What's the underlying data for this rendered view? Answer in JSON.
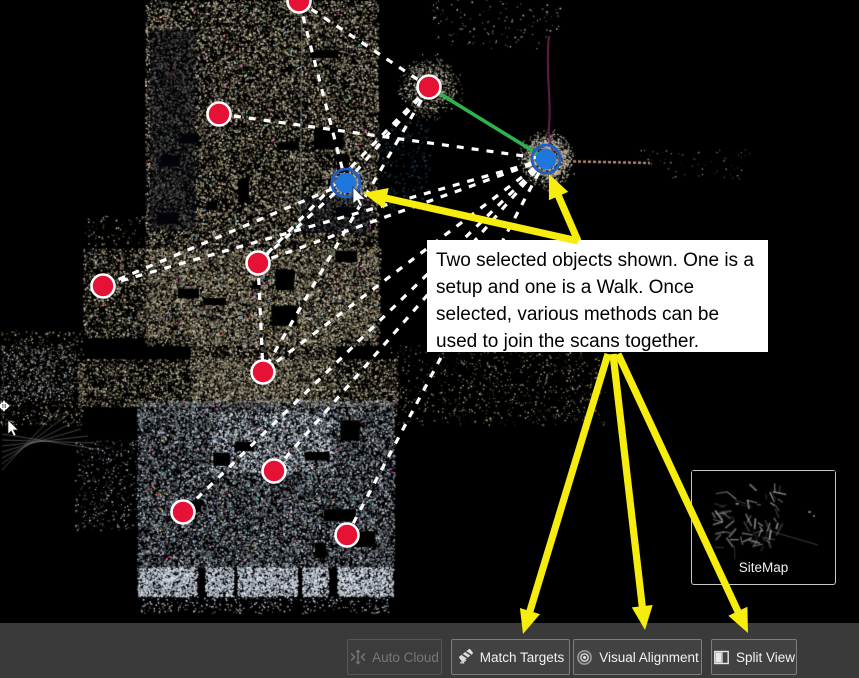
{
  "callout": {
    "lines": [
      "Two selected objects shown. One is a",
      "setup and one is a Walk. Once",
      "selected, various methods can be",
      "used to join the scans together."
    ],
    "text": "Two selected objects shown. One is a setup and one is a Walk. Once selected, various methods can be used to join the scans together.",
    "background": "#ffffff"
  },
  "sitemap": {
    "label": "SiteMap"
  },
  "toolbar": {
    "background": "#3a3a3a",
    "buttons": [
      {
        "label": "Auto Cloud",
        "icon": "auto-cloud-icon",
        "enabled": false
      },
      {
        "label": "Match Targets",
        "icon": "match-targets-icon",
        "enabled": true
      },
      {
        "label": "Visual Alignment",
        "icon": "visual-alignment-icon",
        "enabled": true
      },
      {
        "label": "Split View",
        "icon": "split-view-icon",
        "enabled": true
      }
    ]
  },
  "scene": {
    "colors": {
      "background": "#000000",
      "red_marker": "#e51235",
      "marker_outline": "#ffffff",
      "blue_marker": "#1f76dd",
      "blue_ring": "#1d5fc2",
      "dash_line": "#ffffff",
      "green_link": "#2db24c",
      "yellow_arrow": "#f6ec0d"
    },
    "red_setups": [
      [
        299,
        1
      ],
      [
        219,
        114
      ],
      [
        429,
        87
      ],
      [
        103,
        286
      ],
      [
        258,
        263
      ],
      [
        263,
        372
      ],
      [
        274,
        471
      ],
      [
        183,
        512
      ],
      [
        347,
        535
      ]
    ],
    "selected_objects": [
      [
        346,
        183
      ],
      [
        546,
        159
      ]
    ],
    "green_link": [
      [
        429,
        87
      ],
      [
        546,
        159
      ]
    ],
    "dashed_links": [
      [
        [
          299,
          1
        ],
        [
          429,
          87
        ]
      ],
      [
        [
          346,
          183
        ],
        [
          299,
          1
        ]
      ],
      [
        [
          219,
          114
        ],
        [
          546,
          159
        ]
      ],
      [
        [
          429,
          87
        ],
        [
          346,
          183
        ]
      ],
      [
        [
          429,
          87
        ],
        [
          258,
          263
        ]
      ],
      [
        [
          429,
          87
        ],
        [
          263,
          372
        ]
      ],
      [
        [
          546,
          159
        ],
        [
          103,
          286
        ]
      ],
      [
        [
          546,
          159
        ],
        [
          258,
          263
        ]
      ],
      [
        [
          546,
          159
        ],
        [
          263,
          372
        ]
      ],
      [
        [
          546,
          159
        ],
        [
          274,
          471
        ]
      ],
      [
        [
          546,
          159
        ],
        [
          183,
          512
        ]
      ],
      [
        [
          546,
          159
        ],
        [
          347,
          535
        ]
      ],
      [
        [
          346,
          183
        ],
        [
          103,
          286
        ]
      ],
      [
        [
          346,
          183
        ],
        [
          258,
          263
        ]
      ],
      [
        [
          258,
          263
        ],
        [
          263,
          372
        ]
      ]
    ],
    "yellow_arrows": [
      {
        "from": [
          578,
          241
        ],
        "to": [
          549,
          174
        ]
      },
      {
        "from": [
          578,
          241
        ],
        "to": [
          363,
          193
        ]
      },
      {
        "from": [
          608,
          354
        ],
        "to": [
          523,
          634
        ]
      },
      {
        "from": [
          613,
          354
        ],
        "to": [
          645,
          630
        ]
      },
      {
        "from": [
          618,
          354
        ],
        "to": [
          748,
          633
        ]
      }
    ],
    "cursors": {
      "pointer": [
        353,
        187
      ],
      "pan": [
        8,
        420
      ]
    }
  }
}
